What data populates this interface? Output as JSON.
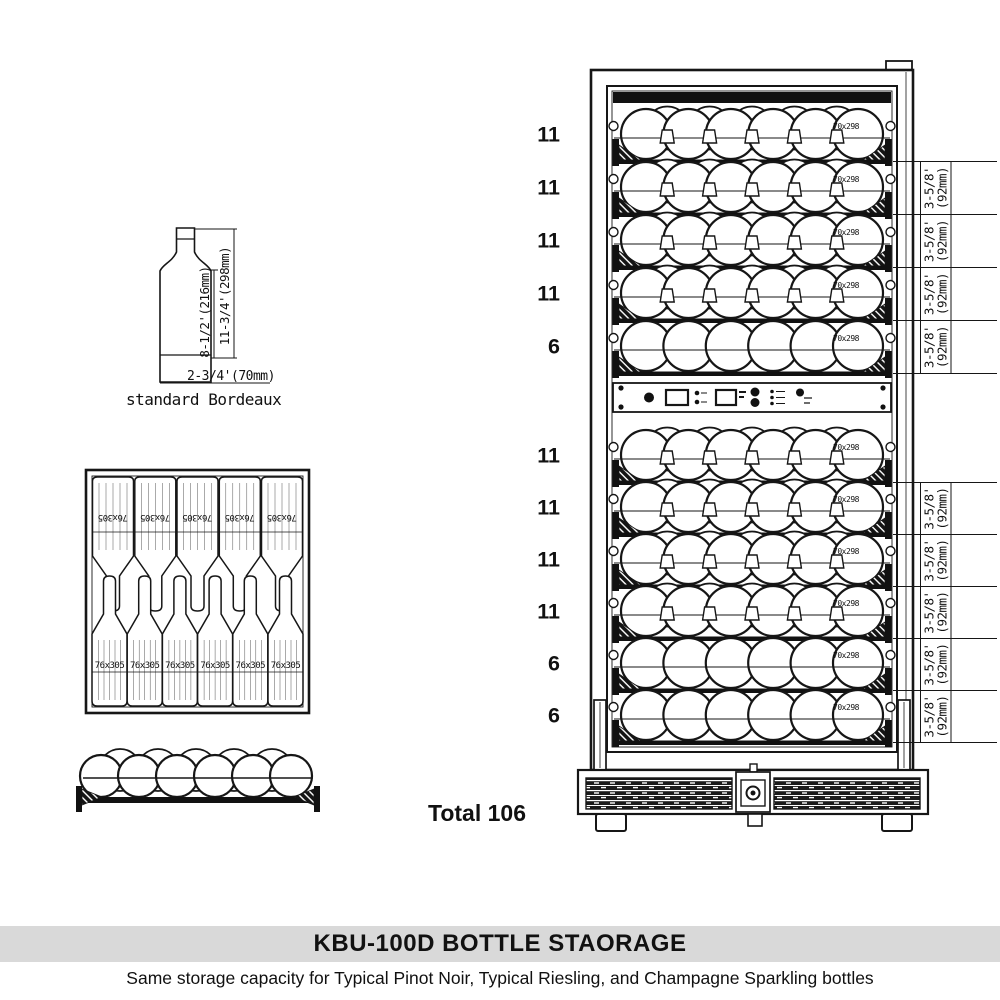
{
  "title_bar": {
    "title": "KBU-100D BOTTLE STAORAGE",
    "subtitle": "Same storage capacity for Typical Pinot Noir, Typical Riesling, and Champagne Sparkling bottles",
    "band_color": "#d9d9d9"
  },
  "bottle_diagram": {
    "caption": "standard Bordeaux",
    "body_height_label": "8-1/2'(216mm)",
    "overall_height_label": "11-3/4'(298mm)",
    "diameter_label": "2-3/4'(70mm)"
  },
  "top_view": {
    "bottle_size_label": "76x305",
    "bottles_neck_down": 5,
    "bottles_neck_up": 6
  },
  "front_view": {
    "front_bottles": 6,
    "back_bottles": 5
  },
  "cooler": {
    "bottle_size_label": "70x298",
    "shelf_spacing_label_inches": "3-5/8'",
    "shelf_spacing_label_mm": "(92mm)",
    "zones": [
      {
        "name": "upper zone",
        "shelf_counts": [
          11,
          11,
          11,
          11,
          6
        ]
      },
      {
        "name": "lower zone",
        "shelf_counts": [
          11,
          11,
          11,
          11,
          6,
          6
        ]
      }
    ],
    "total_label": "Total 106",
    "control_panel_icons": [
      "power-button-icon",
      "temperature-display-icon",
      "up-down-buttons-icon",
      "second-display-icon",
      "mode-buttons-icon",
      "menu-list-icon",
      "light-button-icon"
    ]
  },
  "colors": {
    "line": "#161616",
    "band": "#d9d9d9"
  }
}
